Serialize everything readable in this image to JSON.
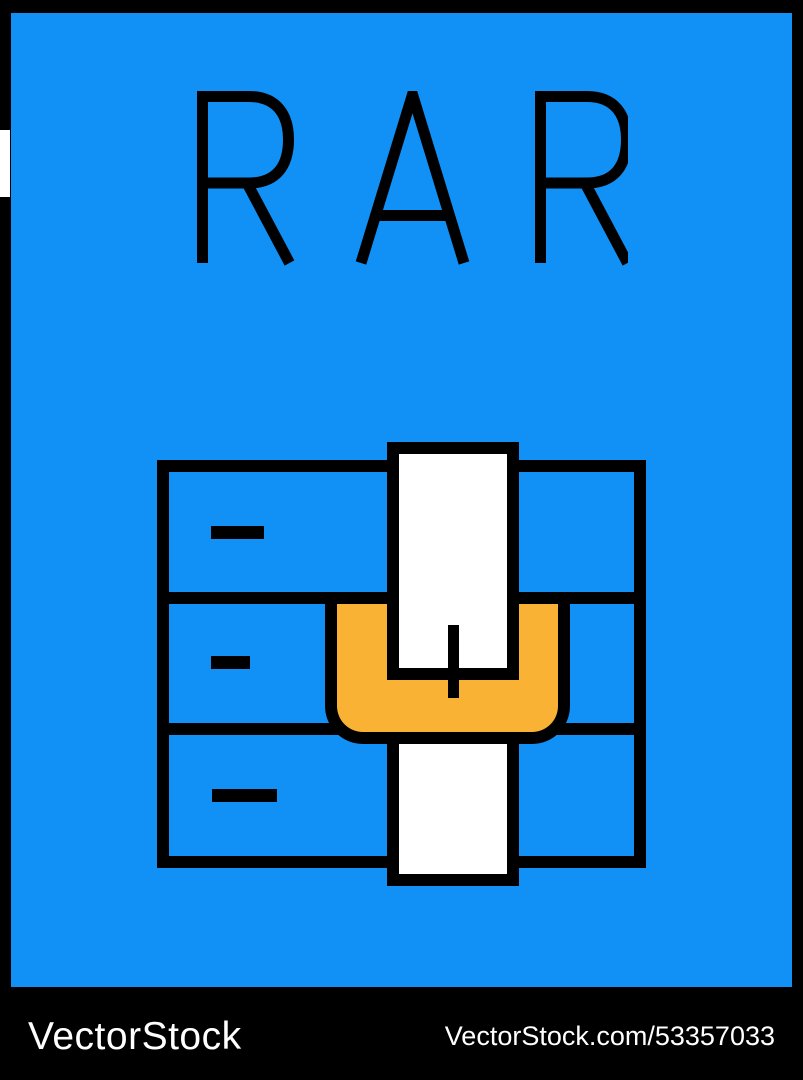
{
  "poster": {
    "title": "RAR",
    "colors": {
      "background": "#1191F5",
      "frame": "#000000",
      "belt_yellow": "#F9B234",
      "tab_white": "#FFFFFF",
      "outline_black": "#000000"
    },
    "icon": {
      "name": "rar-archive-zipper-icon",
      "drawer_count": 3,
      "handle_dashes": 3
    }
  },
  "watermark": {
    "brand": "VectorStock",
    "attribution": "VectorStock.com/53357033"
  }
}
